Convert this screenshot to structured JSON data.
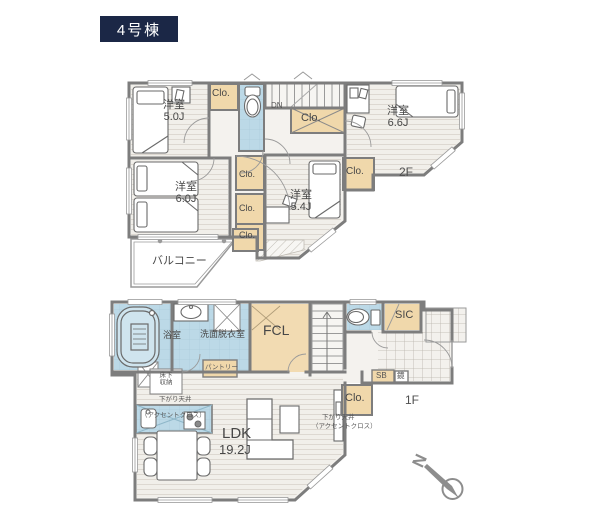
{
  "title": "4号棟",
  "shared": {
    "closet": "Clo."
  },
  "floor2": {
    "label": "2F",
    "down": "DN",
    "balcony": "バルコニー",
    "r50": {
      "name": "洋室",
      "size": "5.0J"
    },
    "r66": {
      "name": "洋室",
      "size": "6.6J"
    },
    "r60": {
      "name": "洋室",
      "size": "6.0J"
    },
    "r54": {
      "name": "洋室",
      "size": "5.4J"
    }
  },
  "floor1": {
    "label": "1F",
    "bath": "浴室",
    "washroom": "洗面脱衣室",
    "fcl": "FCL",
    "sic": "SIC",
    "shoe_box": "SB",
    "mirror": "鏡",
    "pantry": "パントリー",
    "underfloor1": "床下",
    "underfloor2": "収納",
    "lowered_ceiling": "下がり天井",
    "accent": "（アクセントクロス）",
    "ldk": "LDK",
    "ldk_size": "19.2J"
  },
  "compass": {
    "north": "N"
  },
  "colors": {
    "badge_bg": "#1b2746",
    "wet_area_blue": "#bcd9e7",
    "closet_tan": "#f0d8ab",
    "wall_gray": "#7d7d7d"
  }
}
